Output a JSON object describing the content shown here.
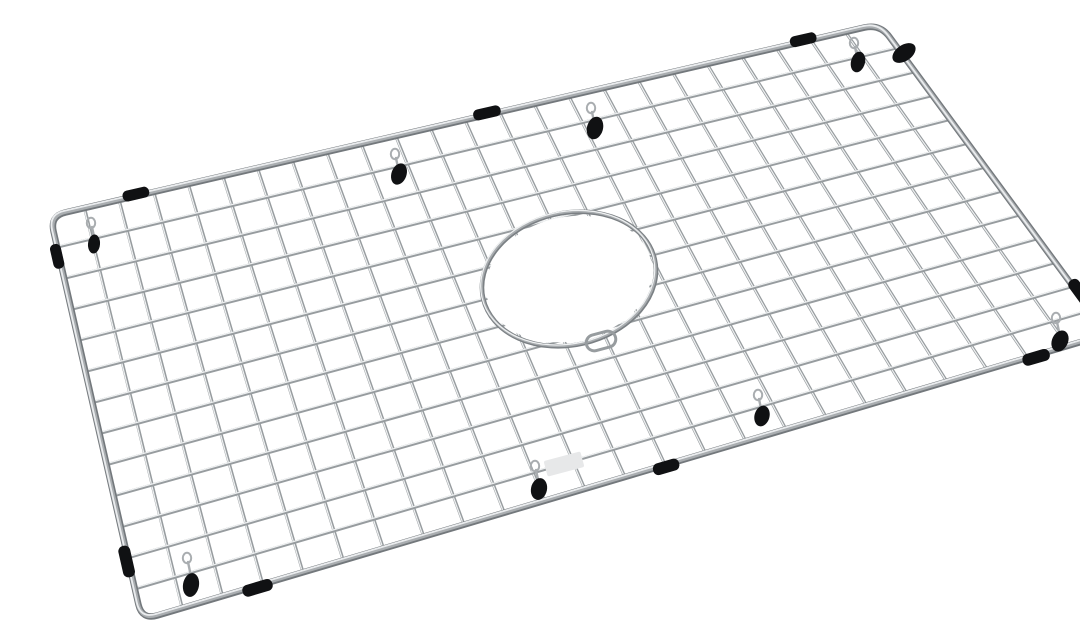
{
  "meta": {
    "subject": "Chrome stainless-steel wire sink bottom grid with circular rear drain opening, black rubber feet and side bumpers, photographed at an angle on a white background",
    "background": "#ffffff"
  },
  "palette": {
    "background": "#ffffff",
    "wire_base": "#979c9f",
    "wire_highlight": "#eff1f2",
    "rim_base": "#73787c",
    "rim_mid": "#a9adb0",
    "rim_highlight": "#eaecee",
    "ring_base": "#7b8084",
    "rubber_black": "#101113",
    "hook_wire": "#a9adb0",
    "label_patch": "#e7e8e9"
  },
  "scene": {
    "canvas": {
      "width": 1080,
      "height": 612
    },
    "frame": {
      "corners": {
        "top_left": [
          10,
          200
        ],
        "top_right": [
          840,
          8
        ],
        "bottom_right": [
          1068,
          318
        ],
        "bottom_left": [
          102,
          604
        ]
      },
      "corner_radius": 16
    },
    "grid": {
      "columns": 24,
      "rows": 13
    },
    "drain_hole": {
      "cx": 529,
      "cy": 263,
      "rx": 88,
      "ry": 66,
      "rotation": -13,
      "handle_loop": {
        "cx": 561,
        "cy": 325,
        "w": 30,
        "h": 16,
        "rotation": -15
      }
    },
    "bumpers": [
      {
        "edge": "top",
        "t": 0.104,
        "len": 27,
        "thick": 11
      },
      {
        "edge": "top",
        "t": 0.527,
        "len": 28,
        "thick": 11
      },
      {
        "edge": "top",
        "t": 0.908,
        "len": 27,
        "thick": 11
      },
      {
        "edge": "left",
        "t": 0.099,
        "len": 25,
        "thick": 11
      },
      {
        "edge": "left",
        "t": 0.854,
        "len": 32,
        "thick": 12
      },
      {
        "edge": "bottom",
        "t": 0.119,
        "len": 31,
        "thick": 12
      },
      {
        "edge": "bottom",
        "t": 0.542,
        "len": 27,
        "thick": 12
      },
      {
        "edge": "bottom",
        "t": 0.925,
        "len": 28,
        "thick": 12
      },
      {
        "edge": "right",
        "t": 0.868,
        "len": 29,
        "thick": 12
      }
    ],
    "feet": [
      {
        "x": 359,
        "y": 158,
        "rot": 20,
        "w": 15,
        "h": 22
      },
      {
        "x": 555,
        "y": 112,
        "rot": 15,
        "w": 16,
        "h": 23
      },
      {
        "x": 818,
        "y": 46,
        "rot": 15,
        "w": 14,
        "h": 21
      },
      {
        "x": 864,
        "y": 37,
        "rot": 55,
        "w": 16,
        "h": 26
      },
      {
        "x": 151,
        "y": 569,
        "rot": 10,
        "w": 16,
        "h": 24
      },
      {
        "x": 499,
        "y": 473,
        "rot": 12,
        "w": 16,
        "h": 22
      },
      {
        "x": 1020,
        "y": 325,
        "rot": 25,
        "w": 16,
        "h": 22
      },
      {
        "x": 54,
        "y": 228,
        "rot": 5,
        "w": 12,
        "h": 19
      },
      {
        "x": 722,
        "y": 400,
        "rot": 15,
        "w": 15,
        "h": 21
      }
    ],
    "hooks": [
      {
        "x": 355,
        "y": 138
      },
      {
        "x": 551,
        "y": 92
      },
      {
        "x": 814,
        "y": 27
      },
      {
        "x": 147,
        "y": 542
      },
      {
        "x": 495,
        "y": 450
      },
      {
        "x": 1016,
        "y": 302
      },
      {
        "x": 718,
        "y": 379
      },
      {
        "x": 51,
        "y": 207
      }
    ],
    "label_patch": {
      "cx": 524,
      "cy": 448,
      "w": 38,
      "h": 16,
      "rotation": -15
    }
  }
}
